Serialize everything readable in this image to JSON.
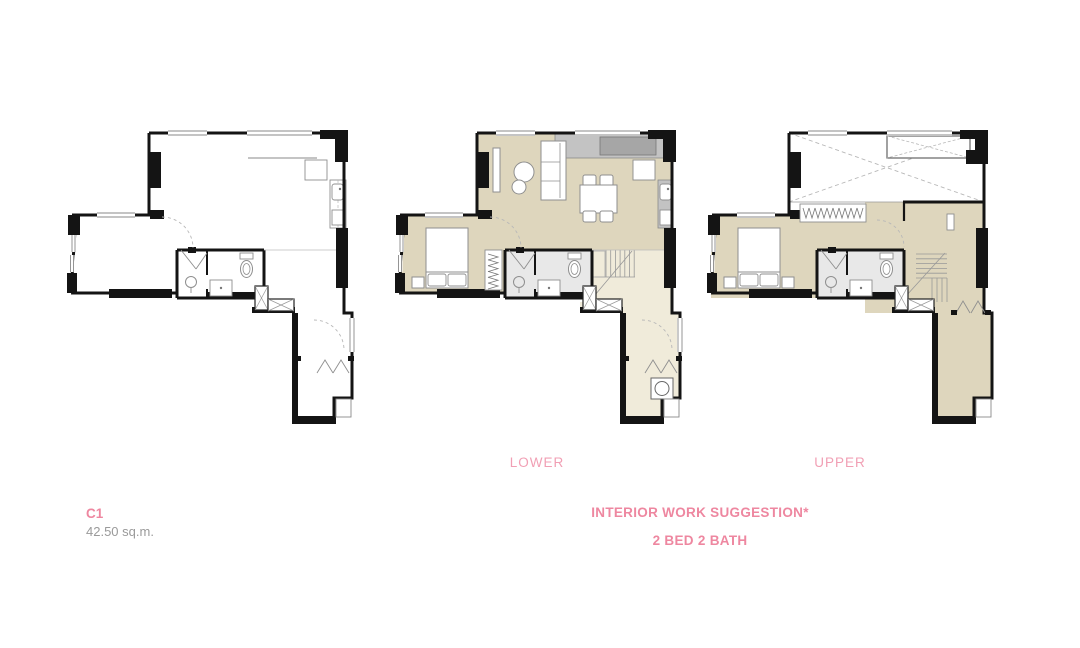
{
  "unit": {
    "code": "C1",
    "area": "42.50 sq.m."
  },
  "plan_labels": {
    "lower": "LOWER",
    "upper": "UPPER"
  },
  "caption": {
    "line1": "INTERIOR WORK SUGGESTION*",
    "line2": "2 BED 2 BATH"
  },
  "plans": [
    {
      "id": "bare",
      "kind": "bare"
    },
    {
      "id": "lower",
      "kind": "lower"
    },
    {
      "id": "upper",
      "kind": "upper"
    }
  ],
  "colors": {
    "pink": "#ee87a0",
    "pink_light": "#f19fb4",
    "gray_text": "#9a9a9a",
    "wall": "#141414",
    "floor": "#ded6bd",
    "floor_light": "#f0ebda",
    "bath_floor": "#e8e8e8",
    "counter": "#c3c3c3",
    "counter_dark": "#a6a6a6",
    "line": "#8a8a8a",
    "fixture": "#8f8f8f",
    "dash": "#b8b8b8"
  }
}
